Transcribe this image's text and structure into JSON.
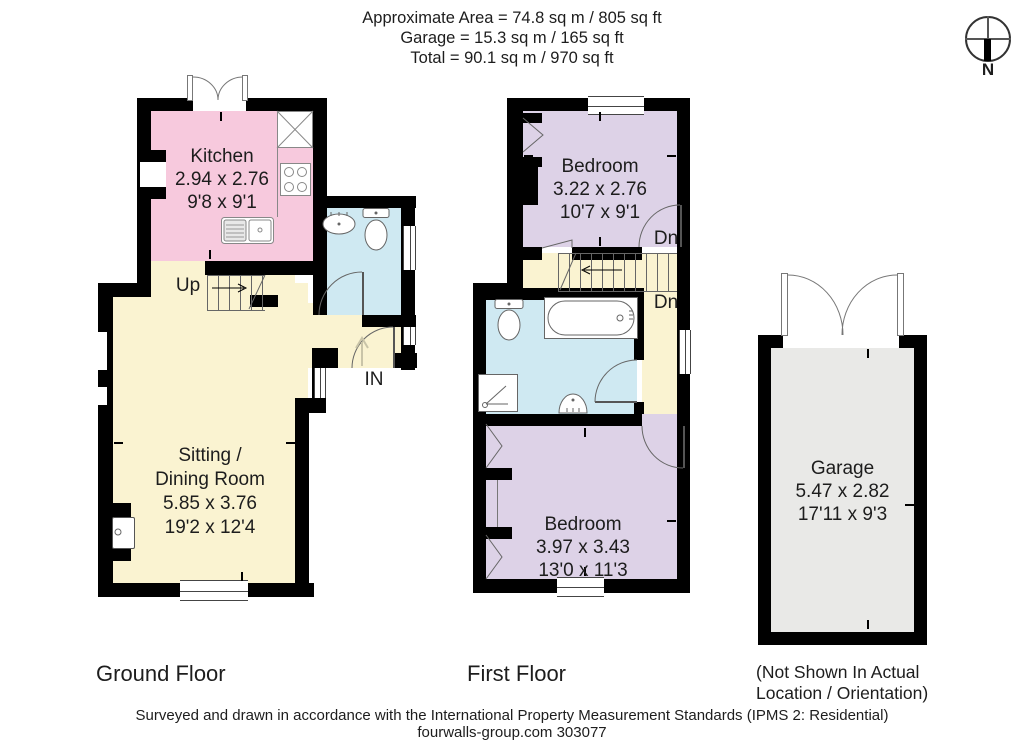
{
  "header": {
    "line1": "Approximate Area = 74.8 sq m / 805 sq ft",
    "line2": "Garage = 15.3 sq m / 165 sq ft",
    "line3": "Total = 90.1 sq m / 970 sq ft"
  },
  "compass": {
    "north_label": "N"
  },
  "ground_floor": {
    "title": "Ground Floor",
    "kitchen": {
      "name": "Kitchen",
      "size_metric": "2.94 x 2.76",
      "size_imperial": "9'8 x 9'1"
    },
    "sitting_dining": {
      "name_line1": "Sitting /",
      "name_line2": "Dining Room",
      "size_metric": "5.85 x 3.76",
      "size_imperial": "19'2 x 12'4"
    },
    "stairs_label": "Up",
    "entrance_label": "IN"
  },
  "first_floor": {
    "title": "First Floor",
    "bedroom_1": {
      "name": "Bedroom",
      "size_metric": "3.22 x 2.76",
      "size_imperial": "10'7 x 9'1"
    },
    "bedroom_2": {
      "name": "Bedroom",
      "size_metric": "3.97 x 3.43",
      "size_imperial": "13'0 x 11'3"
    },
    "stairs_label_1": "Dn",
    "stairs_label_2": "Dn"
  },
  "garage": {
    "name": "Garage",
    "size_metric": "5.47 x 2.82",
    "size_imperial": "17'11 x 9'3",
    "note_line1": "(Not Shown In Actual",
    "note_line2": "Location / Orientation)"
  },
  "footer": {
    "line1": "Surveyed and drawn in accordance with the International Property Measurement Standards (IPMS 2: Residential)",
    "line2": "fourwalls-group.com 303077"
  },
  "colors": {
    "wall": "#000000",
    "kitchen": "#f7c9dd",
    "living": "#faf3d1",
    "bathroom": "#cfe9f2",
    "bedroom": "#ddd2e7",
    "garage": "#e9e9e7",
    "fixture_line": "#666666"
  }
}
